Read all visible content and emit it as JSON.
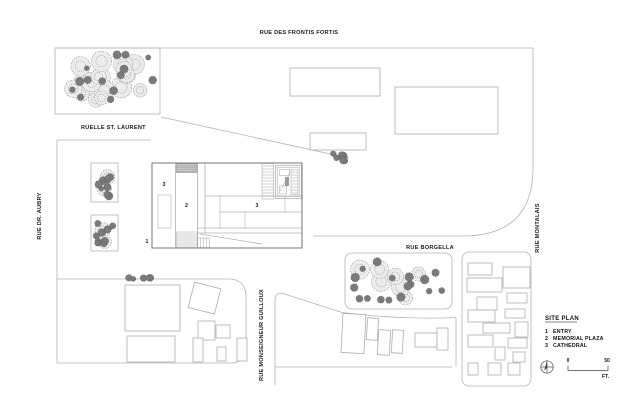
{
  "drawing": {
    "streets": {
      "frontis_fortis": "RUE DES FRONTIS FORTIS",
      "st_laurent": "RUELLE ST. LAURENT",
      "dr_aubry": "RUE DR. AUBRY",
      "montalais": "RUE MONTALAIS",
      "borgella": "RUE BORGELLA",
      "guilloux": "RUE MONSEIGNEUR GUILLOUX"
    },
    "markers": {
      "entry": "1",
      "plaza": "2",
      "cathedral_a": "3",
      "cathedral_b": "3"
    },
    "legend": {
      "title": "SITE PLAN",
      "items": [
        {
          "num": "1",
          "label": "ENTRY"
        },
        {
          "num": "2",
          "label": "MEMORIAL PLAZA"
        },
        {
          "num": "3",
          "label": "CATHEDRAL"
        }
      ]
    },
    "scale": {
      "zero": "0",
      "fifty": "50",
      "unit": "FT."
    },
    "colors": {
      "line": "#b3b3b3",
      "building": "#a8a8a8",
      "detail": "#6e6e6e",
      "text": "#1a1a1a",
      "tree_light_fill": "#ececec",
      "tree_light_stroke": "#9a9a9a",
      "tree_dark_fill": "#7a7a7a",
      "tree_dark_stroke": "#555555"
    }
  }
}
